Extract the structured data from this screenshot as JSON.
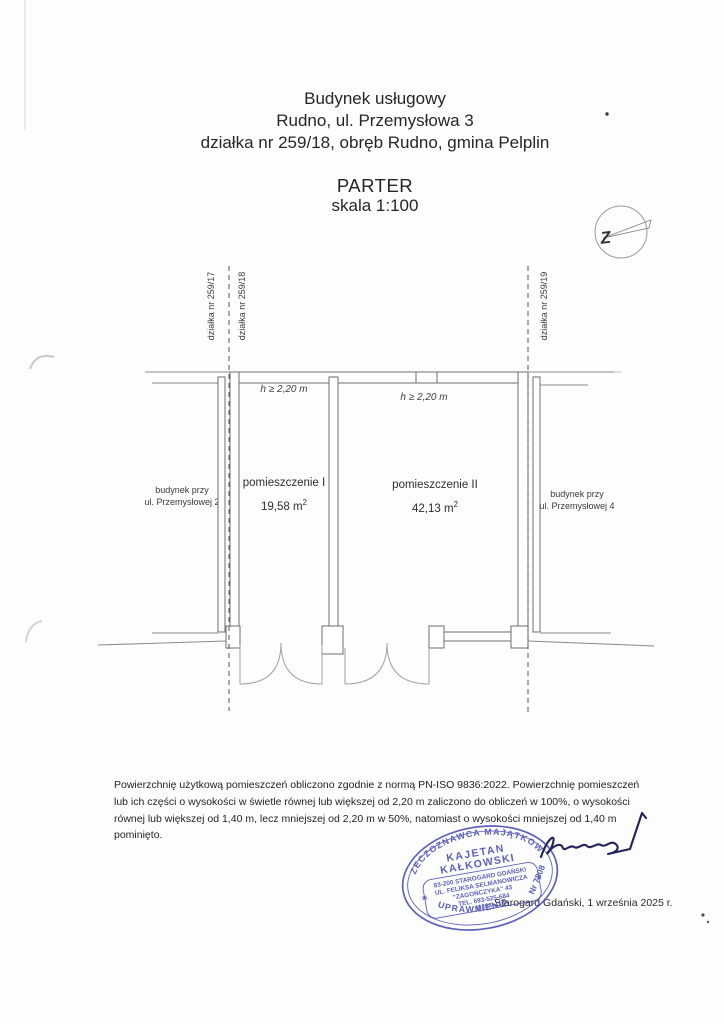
{
  "header": {
    "title_lines": [
      "Budynek usługowy",
      "Rudno, ul. Przemysłowa 3",
      "działka nr 259/18, obręb Rudno, gmina Pelplin"
    ],
    "plan_level": "PARTER",
    "scale": "skala 1:100"
  },
  "north_arrow": {
    "letter": "Z"
  },
  "parcels": {
    "left_of_left_line": "działka nr 259/17",
    "right_of_left_line": "działka nr 259/18",
    "right_of_right_line": "działka nr 259/19"
  },
  "plan": {
    "room1": {
      "name": "pomieszczenie I",
      "area": "19,58 m",
      "area_sup": "2",
      "height_note": "h ≥ 2,20 m"
    },
    "room2": {
      "name": "pomieszczenie II",
      "area": "42,13 m",
      "area_sup": "2",
      "height_note": "h ≥ 2,20 m"
    },
    "neighbor_left": {
      "line1": "budynek przy",
      "line2": "ul. Przemysłowej 2"
    },
    "neighbor_right": {
      "line1": "budynek przy",
      "line2": "ul. Przemysłowej 4"
    }
  },
  "footnote": "Powierzchnię użytkową pomieszczeń obliczono zgodnie z normą PN-ISO 9836:2022. Powierzchnię pomieszczeń lub ich części o wysokości w świetle równej lub większej od 2,20 m zaliczono do obliczeń w 100%, o wysokości równej lub większej od 1,40 m, lecz mniejszej od 2,20 m w 50%, natomiast o wysokości mniejszej od 1,40 m pominięto.",
  "stamp": {
    "arc_top": "RZECZOZNAWCA MAJĄTKOWY",
    "name_line1": "KAJETAN",
    "name_line2": "KAŁKOWSKI",
    "address_line1": "83-200 STAROGARD GDAŃSKI",
    "address_line2": "UL. FELIKSA SELMANOWICZA",
    "address_line3": "\"ZAGOŃCZYKA\" 43",
    "phone": "TEL. 693-525-684",
    "reg_number": "(6268)",
    "arc_bottom": "UPRAWNIENIA",
    "license": "Nr 7308",
    "ink_color": "#3f43ae"
  },
  "date_line": "Starogard Gdański, 1 września 2025 r."
}
